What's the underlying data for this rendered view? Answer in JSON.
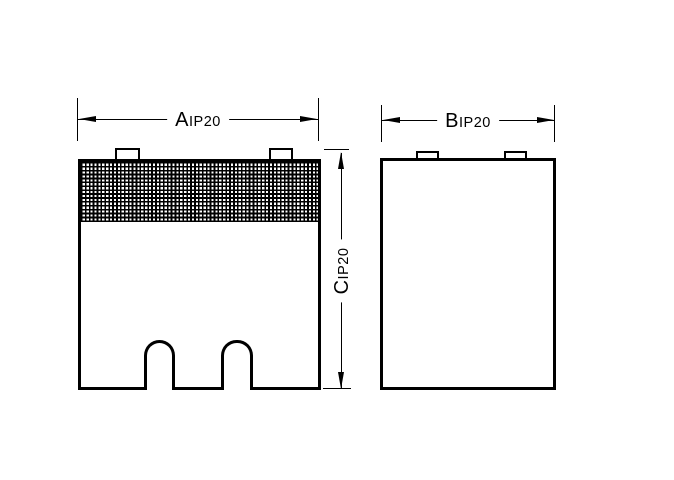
{
  "drawing": {
    "colors": {
      "line": "#000000",
      "background": "#ffffff"
    },
    "dim_a": {
      "letter": "A",
      "suffix": "IP20"
    },
    "dim_b": {
      "letter": "B",
      "suffix": "IP20"
    },
    "dim_c": {
      "letter": "C",
      "suffix": "IP20"
    }
  }
}
